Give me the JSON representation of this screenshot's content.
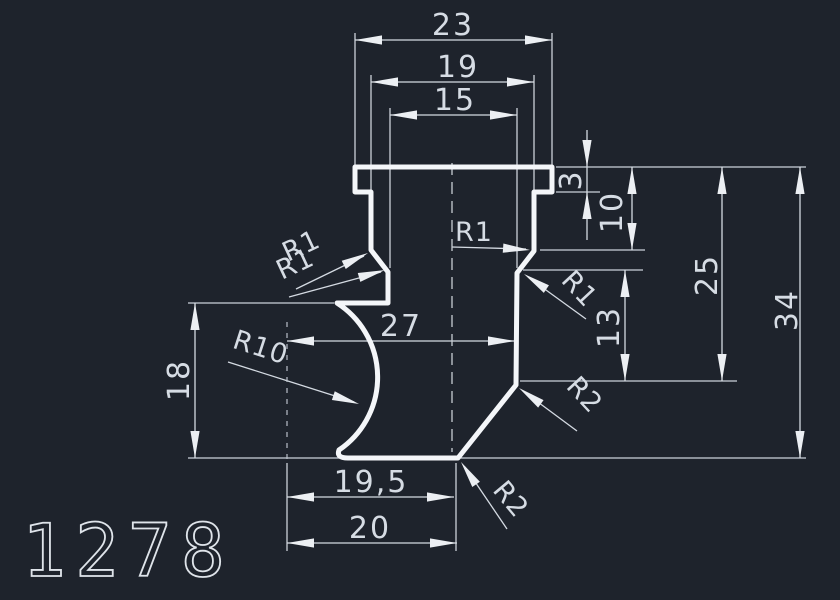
{
  "canvas": {
    "background_color": "#1e232c",
    "profile_line_color": "#f4f6f9",
    "dimension_line_color": "#ccd2da",
    "text_color": "#d6dce4"
  },
  "dimensions": {
    "top": {
      "overall_width": "23",
      "step_width": "19",
      "neck_width": "15"
    },
    "middle": {
      "center_width": "27"
    },
    "bottom": {
      "base_width_inner": "19,5",
      "base_width_outer": "20"
    },
    "left": {
      "side_height": "18"
    },
    "right": {
      "lip_depth": "3",
      "head_depth": "10",
      "shoulder_height": "13",
      "upper_height": "25",
      "overall_height": "34"
    }
  },
  "radius_labels": {
    "left_upper": "R1",
    "left_lower": "R1",
    "center": "R1",
    "right": "R1",
    "shoulder": "R2",
    "base": "R2",
    "cove": "R10"
  },
  "drawing_number": "1278"
}
